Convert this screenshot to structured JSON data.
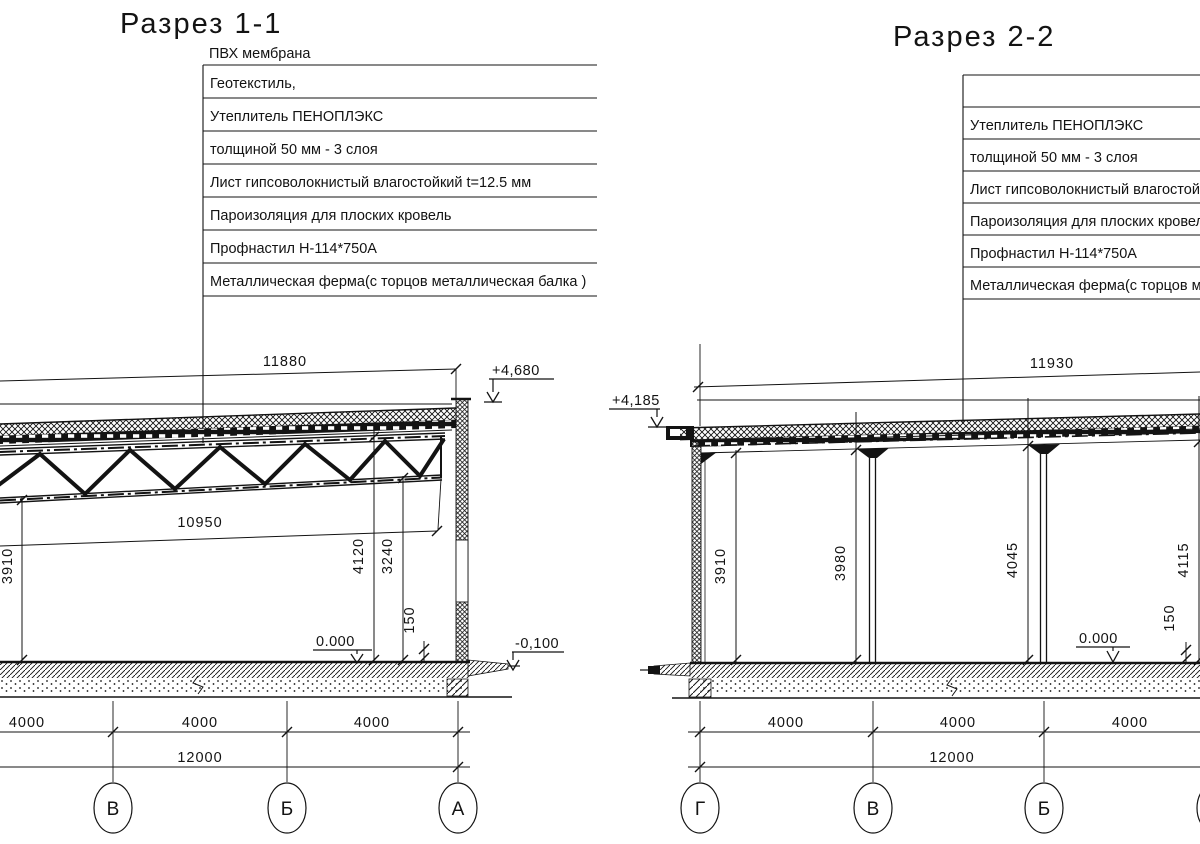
{
  "colors": {
    "ink": "#131313",
    "paper": "#ffffff"
  },
  "sections": {
    "left": {
      "title": "Разрез 1-1",
      "pvc_label": "ПВХ мембрана",
      "layers": [
        "Геотекстиль,",
        "Утеплитель ПЕНОПЛЭКС",
        "толщиной 50 мм - 3 слоя",
        "Лист гипсоволокнистый влагостойкий t=12.5 мм",
        "Пароизоляция для плоских кровель",
        "Профнастил Н-114*750А",
        "Металлическая ферма(с торцов металлическая балка )"
      ],
      "dim_span": "11880",
      "dim_chord": "10950",
      "heights": [
        "3910",
        "4120",
        "3240"
      ],
      "step": "150",
      "level_roof": "+4,680",
      "level_floor": "0.000",
      "level_outside": "-0,100",
      "bays": [
        "4000",
        "4000",
        "4000"
      ],
      "total": "12000",
      "grids": [
        "В",
        "Б",
        "А"
      ]
    },
    "right": {
      "title": "Разрез 2-2",
      "layers": [
        "",
        "Утеплитель ПЕНОПЛЭКС",
        "толщиной 50 мм - 3 слоя",
        "Лист гипсоволокнистый влагостойкий t=12.5 мм",
        "Пароизоляция для плоских кровель",
        "Профнастил Н-114*750А",
        "Металлическая ферма(с торцов металлическая балка )"
      ],
      "dim_span": "11930",
      "heights": [
        "3910",
        "3980",
        "4045",
        "4115"
      ],
      "step": "150",
      "level_roof": "+4,185",
      "level_floor": "0.000",
      "bays": [
        "4000",
        "4000",
        "4000"
      ],
      "total": "12000",
      "grids": [
        "Г",
        "В",
        "Б"
      ]
    }
  }
}
